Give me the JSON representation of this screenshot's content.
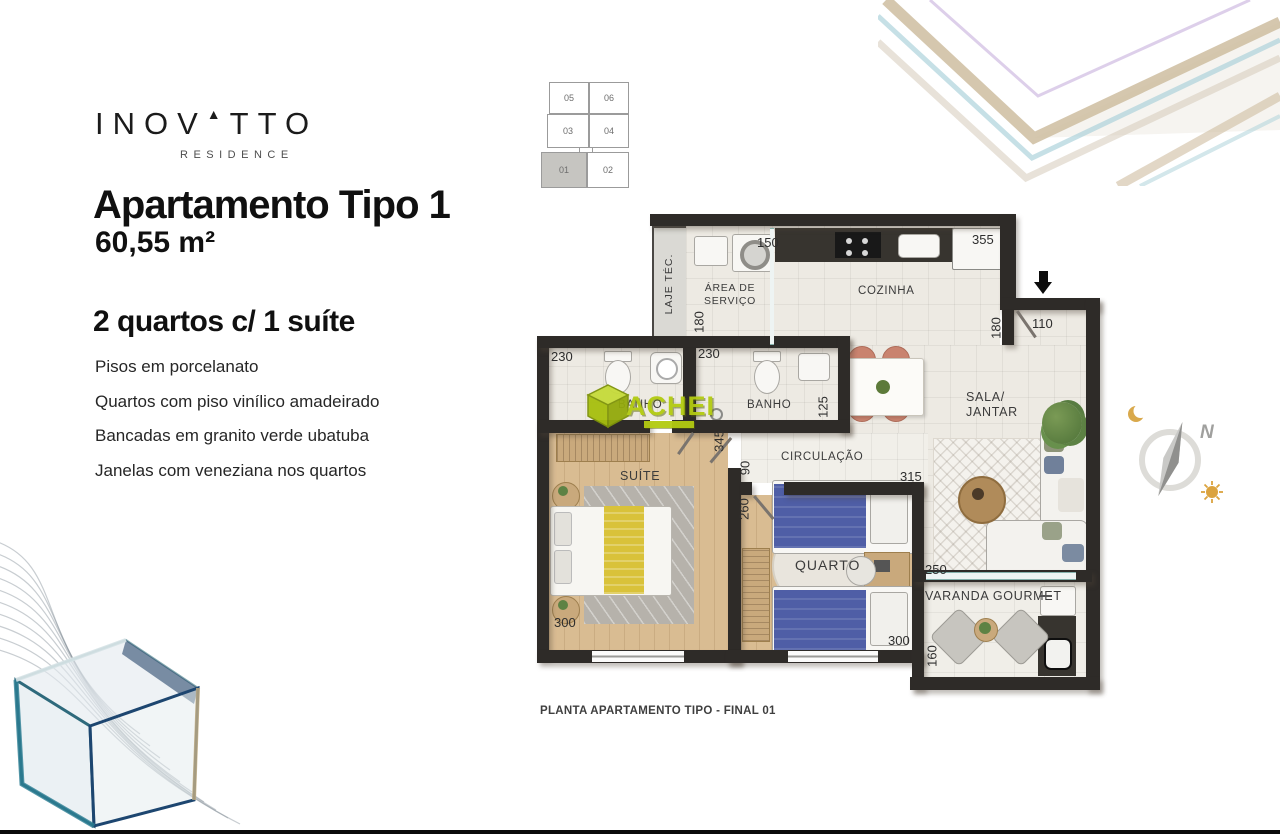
{
  "branding": {
    "logo_a": "INOV",
    "logo_mark": "▲",
    "logo_b": "TTO",
    "residence": "RESIDENCE"
  },
  "header": {
    "title": "Apartamento Tipo 1",
    "area": "60,55 m²"
  },
  "specs": {
    "heading": "2 quartos c/ 1 suíte",
    "features": [
      "Pisos em porcelanato",
      "Quartos com piso vinílico amadeirado",
      "Bancadas em granito verde ubatuba",
      "Janelas com veneziana nos quartos"
    ]
  },
  "keyplan": {
    "units": [
      "05",
      "06",
      "03",
      "04",
      "01",
      "02"
    ],
    "highlighted": "01"
  },
  "plan": {
    "rooms": {
      "laje": "LAJE TÉC.",
      "servico": "ÁREA DE SERVIÇO",
      "cozinha": "COZINHA",
      "banho_suite": "BANHO",
      "banho_social": "BANHO",
      "sala_line1": "SALA/",
      "sala_line2": "JANTAR",
      "circulacao": "CIRCULAÇÃO",
      "suite": "SUÍTE",
      "quarto": "QUARTO",
      "varanda": "VARANDA GOURMET"
    },
    "dims": {
      "servico_width": "150",
      "servico_height": "180",
      "fridge_width": "355",
      "cozinha_height": "180",
      "entry_width": "110",
      "banho_suite_width": "230",
      "banho_social_width": "230",
      "banho_social_height": "125",
      "suite_depth": "345",
      "hall_width": "90",
      "quarto_depth": "260",
      "sala_width": "315",
      "suite_width": "300",
      "quarto_width": "300",
      "varanda_width": "250",
      "varanda_depth": "160"
    },
    "caption": "PLANTA APARTAMENTO TIPO - FINAL 01"
  },
  "compass": {
    "north": "N"
  },
  "watermark": {
    "text": "ACHEI"
  },
  "colors": {
    "wall": "#2e2b28",
    "tile": "#edeae3",
    "wood": "#d9bc92",
    "bed_blue": "#4f5ea6",
    "bed_yellow": "#d9c23a",
    "chair_salmon": "#c9836f",
    "watermark_green": "#b3cb11"
  }
}
